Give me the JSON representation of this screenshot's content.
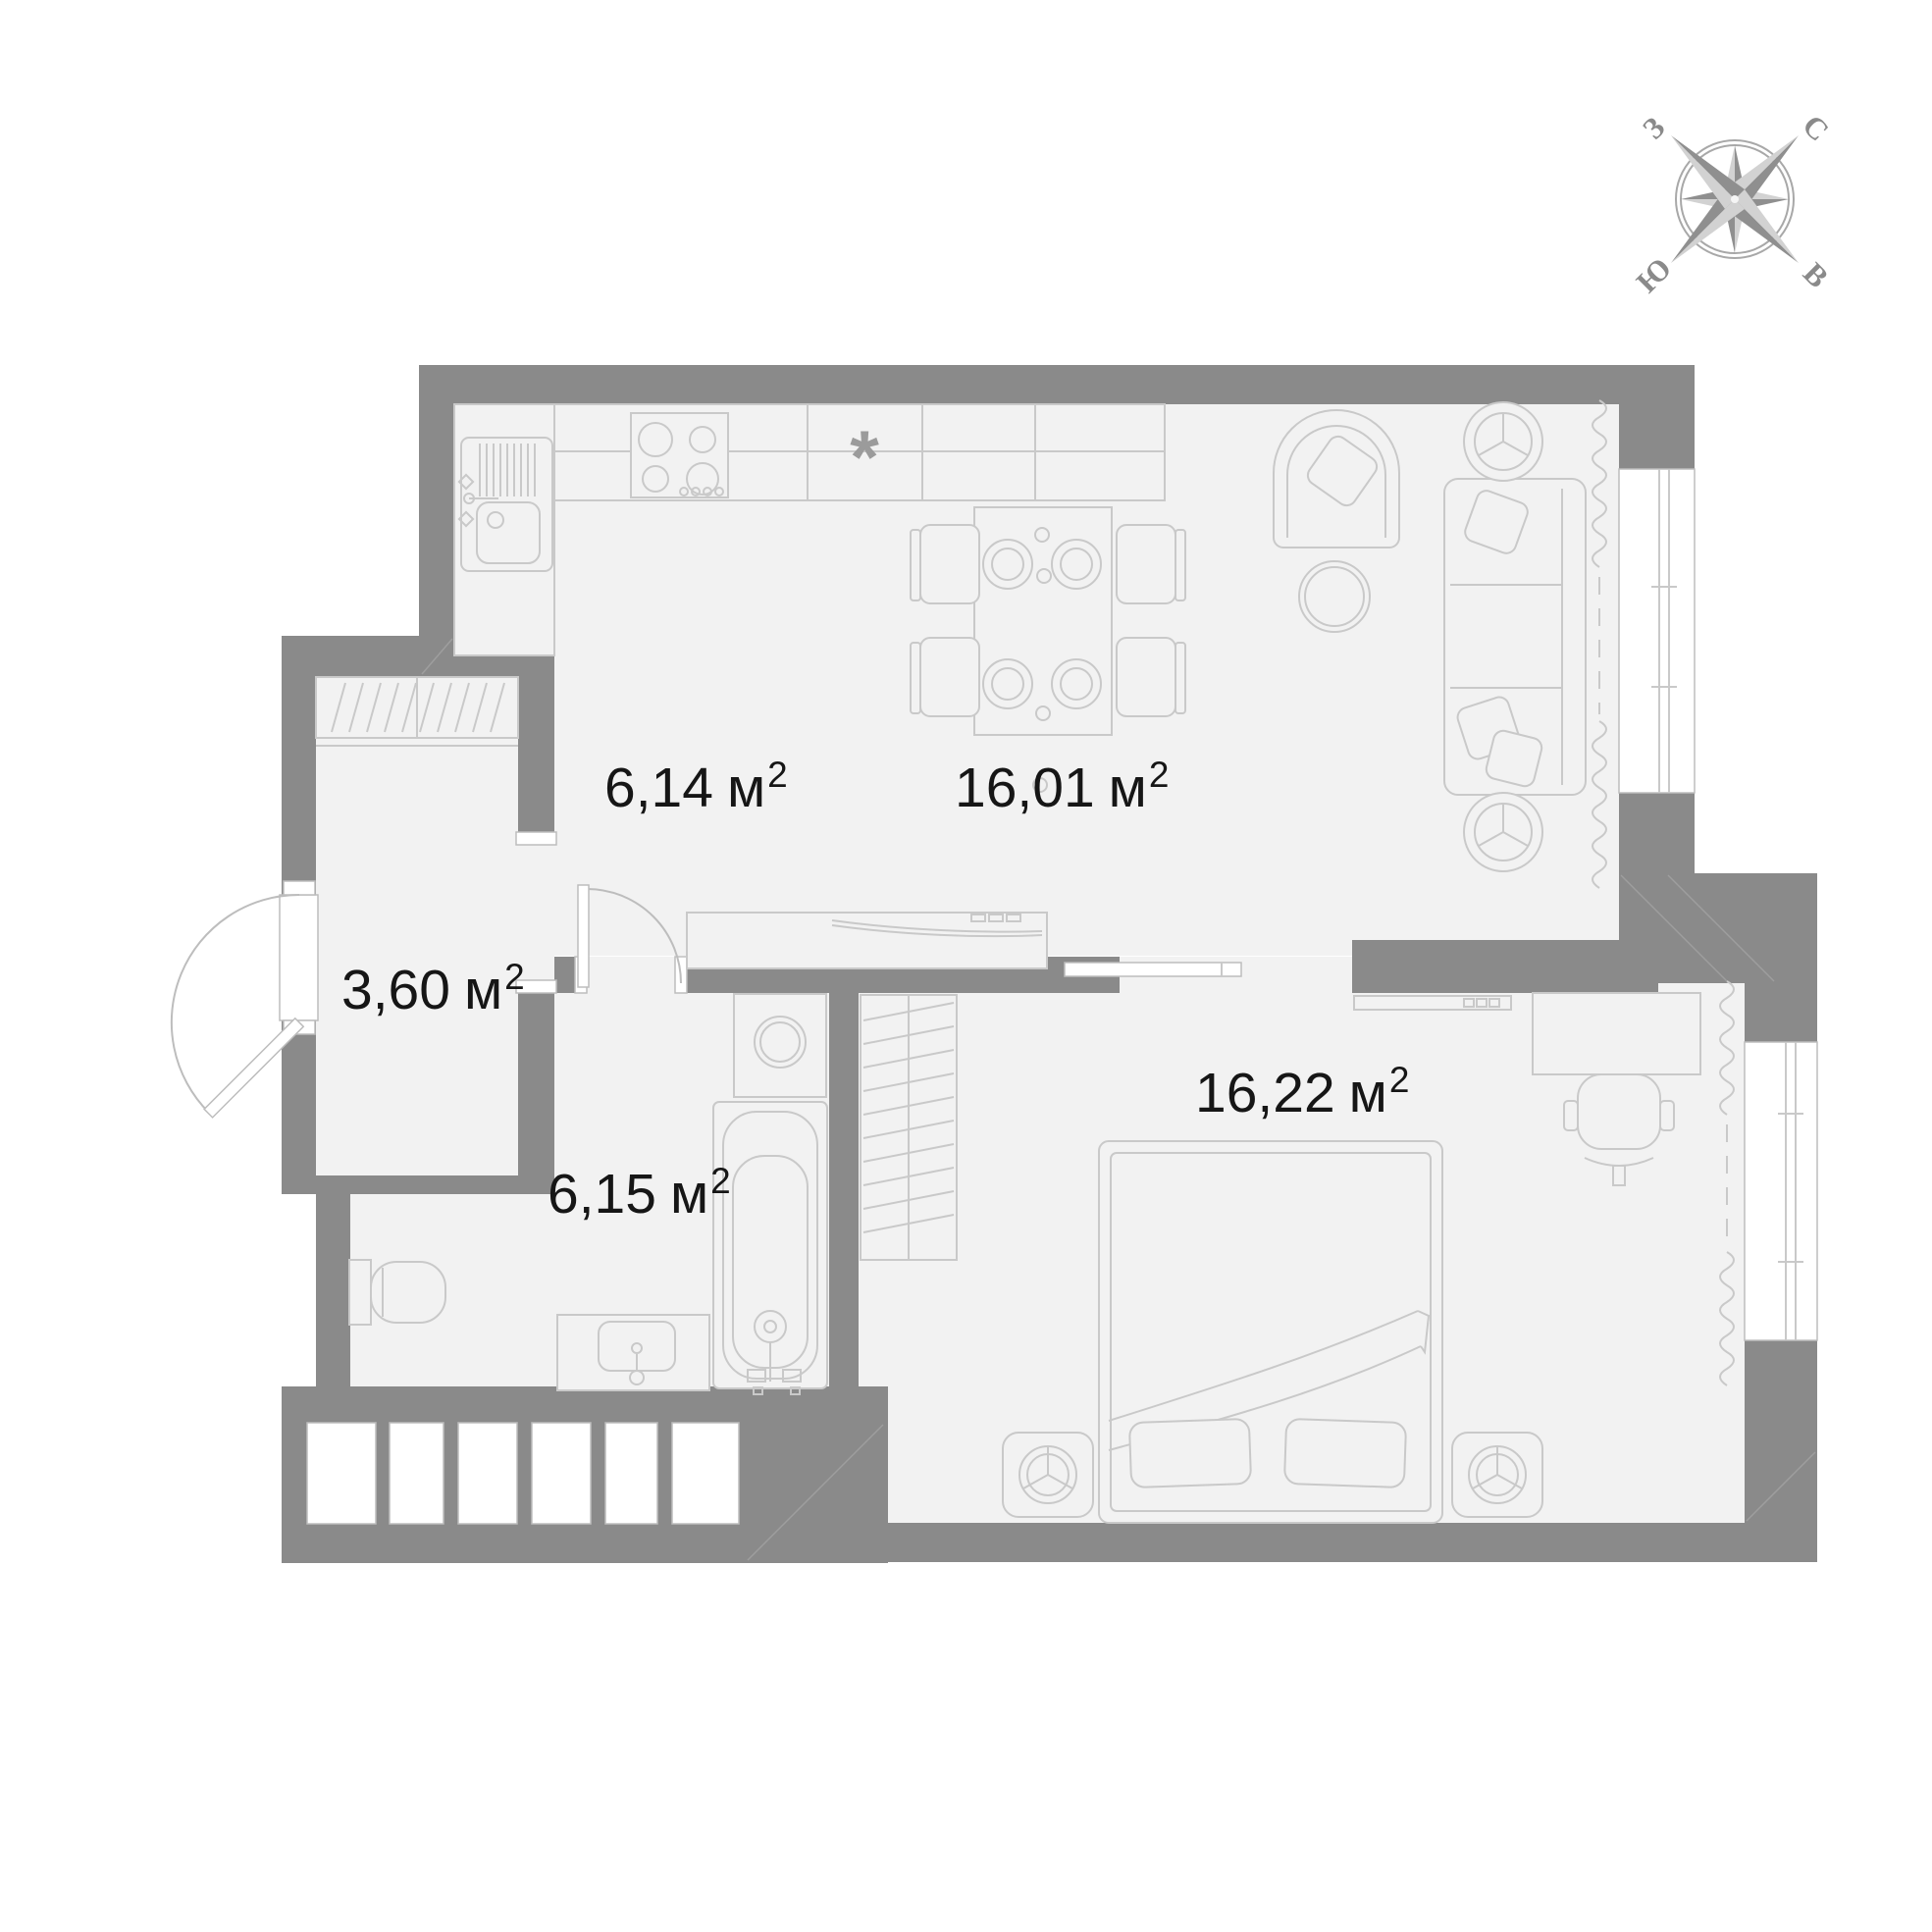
{
  "plan_title": "apartment-floor-plan",
  "compass": {
    "north_label": "С",
    "east_label": "В",
    "south_label": "Ю",
    "west_label": "З"
  },
  "rooms": [
    {
      "name": "kitchen-zone",
      "area": "6,14",
      "unit": "м",
      "sup": "2"
    },
    {
      "name": "living-dining-zone",
      "area": "16,01",
      "unit": "м",
      "sup": "2"
    },
    {
      "name": "entrance-hall",
      "area": "3,60",
      "unit": "м",
      "sup": "2"
    },
    {
      "name": "bathroom",
      "area": "6,15",
      "unit": "м",
      "sup": "2"
    },
    {
      "name": "bedroom",
      "area": "16,22",
      "unit": "м",
      "sup": "2"
    }
  ],
  "symbols": {
    "refrigerator": "*"
  },
  "colors": {
    "wall": "#8a8a8a",
    "floor": "#f2f2f2",
    "furniture_line": "#c9c9c9",
    "label_text": "#161616",
    "compass_dark": "#8f8f8f",
    "compass_light": "#d2d2d2"
  }
}
